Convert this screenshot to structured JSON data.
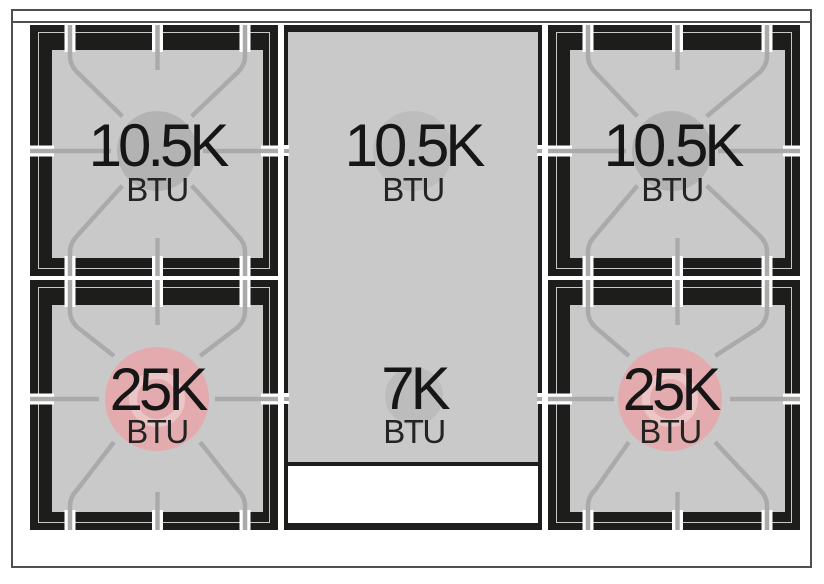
{
  "cooktop": {
    "surface_color": "#1d1d1b",
    "well_color": "#c9c9c9",
    "grate_color": "#aaaaaa",
    "high_power_color": "#e3abad",
    "burners": [
      {
        "label": "10.5K",
        "unit": "BTU",
        "flame_color": "#b3b3b3"
      },
      {
        "label": "10.5K",
        "unit": "BTU",
        "flame_color": "#bdbdbd"
      },
      {
        "label": "10.5K",
        "unit": "BTU",
        "flame_color": "#b3b3b3"
      },
      {
        "label": "25K",
        "unit": "BTU",
        "flame_color": "#e3abad"
      },
      {
        "label": "7K",
        "unit": "BTU",
        "flame_color": "#bcbcbc"
      },
      {
        "label": "25K",
        "unit": "BTU",
        "flame_color": "#e3abad"
      }
    ]
  }
}
